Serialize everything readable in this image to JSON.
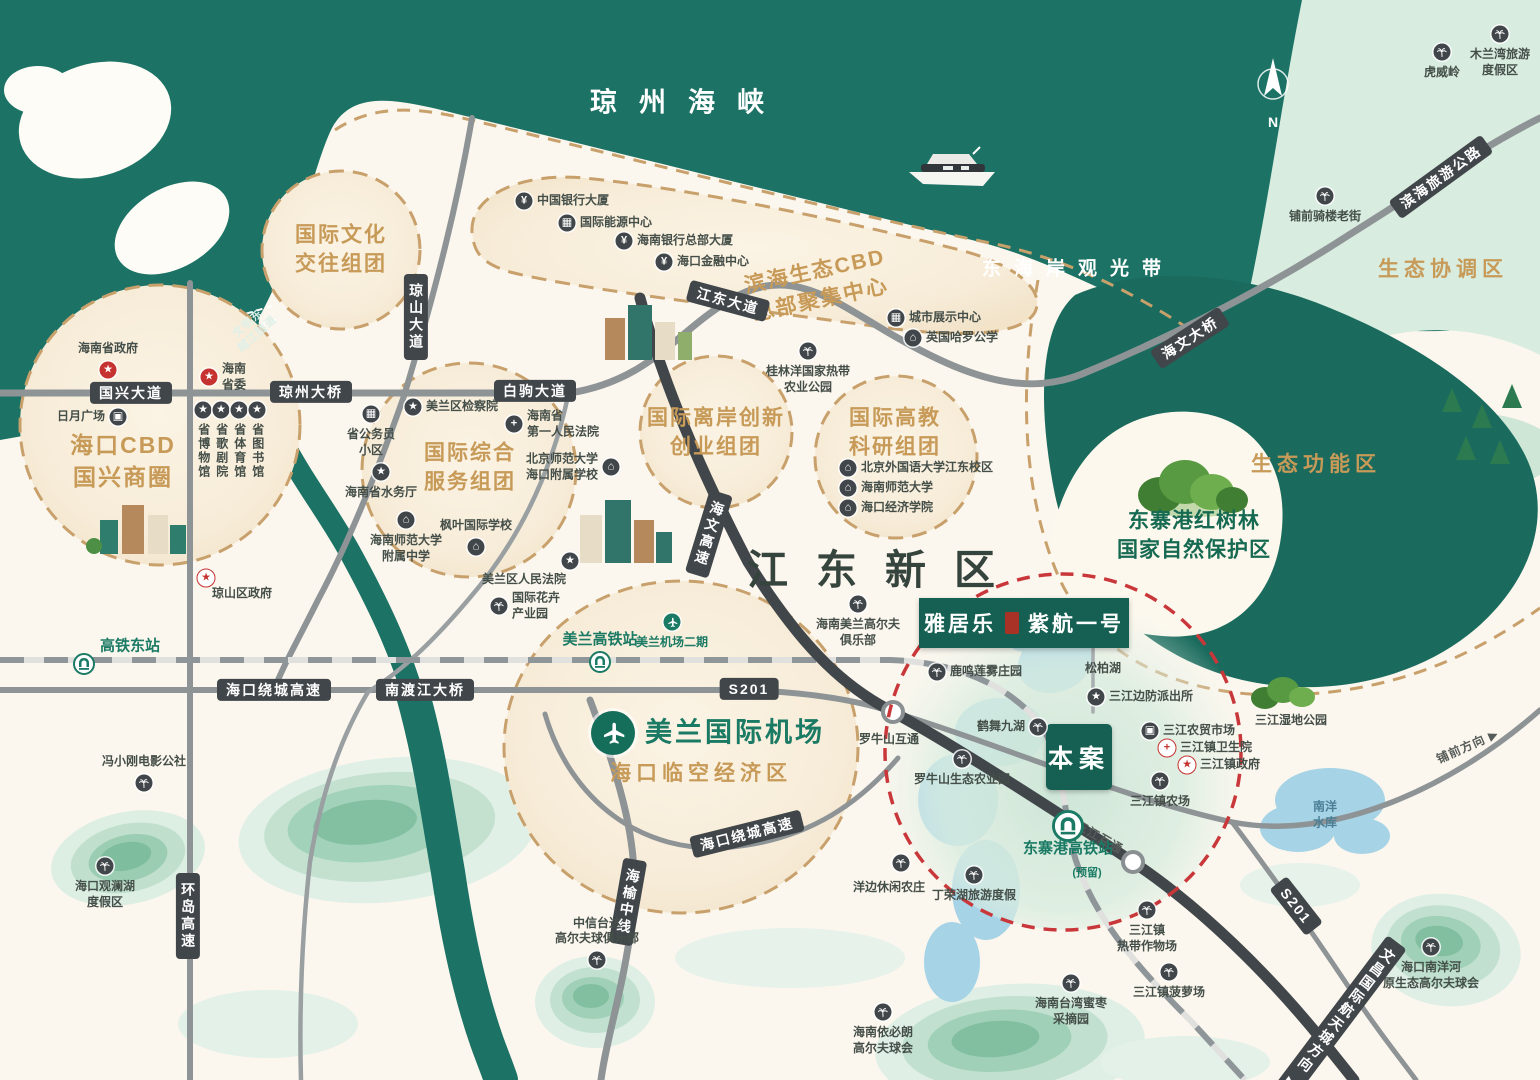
{
  "meta": {
    "compass": "N"
  },
  "banner": {
    "brand": "雅居乐",
    "project": "紫航一号"
  },
  "site_marker": "本案",
  "colors": {
    "sea": "#1b7265",
    "gold": "#c79a58",
    "green": "#1a7a64",
    "red_dash": "#c9373a",
    "road_dark": "#41464a",
    "tan_dash": "#c8a06b"
  },
  "area_labels": [
    {
      "text": "琼州海峡",
      "x": 688,
      "y": 100,
      "cls": "al-sea"
    },
    {
      "text": "东海岸观光带",
      "x": 1078,
      "y": 267,
      "cls": "al-coast"
    },
    {
      "text": "江东新区",
      "x": 885,
      "y": 566,
      "cls": "al-district"
    },
    {
      "text": "滨海生态CBD\n总部聚集中心",
      "x": 818,
      "y": 286,
      "cls": "al-gold-md",
      "rot": -12
    },
    {
      "text": "国际文化\n交往组团",
      "x": 341,
      "y": 250,
      "cls": "al-gold-md"
    },
    {
      "text": "国际综合\n服务组团",
      "x": 470,
      "y": 468,
      "cls": "al-gold-md"
    },
    {
      "text": "国际离岸创新\n创业组团",
      "x": 716,
      "y": 433,
      "cls": "al-gold-md"
    },
    {
      "text": "国际高教\n科研组团",
      "x": 895,
      "y": 433,
      "cls": "al-gold-md"
    },
    {
      "text": "海口CBD\n国兴商圈",
      "x": 123,
      "y": 461,
      "cls": "al-gold-lg"
    },
    {
      "text": "海口临空经济区",
      "x": 701,
      "y": 772,
      "cls": "al-gold-md2"
    },
    {
      "text": "生态协调区",
      "x": 1443,
      "y": 268,
      "cls": "al-gold-md2"
    },
    {
      "text": "生态功能区",
      "x": 1316,
      "y": 463,
      "cls": "al-gold-md2"
    },
    {
      "text": "东寨港红树林\n国家自然保护区",
      "x": 1194,
      "y": 536,
      "cls": "al-green-dk"
    },
    {
      "text": "文明东\n越江隧道",
      "x": 253,
      "y": 329,
      "cls": "al-tunnel",
      "rot": -42
    },
    {
      "text": "(预留)",
      "x": 1087,
      "y": 872,
      "cls": "al-green-sm"
    }
  ],
  "road_labels": [
    {
      "text": "国兴大道",
      "x": 131,
      "y": 393
    },
    {
      "text": "琼州大桥",
      "x": 311,
      "y": 392
    },
    {
      "text": "白驹大道",
      "x": 535,
      "y": 391
    },
    {
      "text": "江东大道",
      "x": 728,
      "y": 301,
      "rot": 15
    },
    {
      "text": "海文大桥",
      "x": 1190,
      "y": 338,
      "rot": -33
    },
    {
      "text": "滨海旅游公路",
      "x": 1441,
      "y": 177,
      "rot": -36
    },
    {
      "text": "琼山大道",
      "x": 416,
      "y": 317,
      "vertical": true
    },
    {
      "text": "海文高速",
      "x": 709,
      "y": 534,
      "vertical": true,
      "rot": 17
    },
    {
      "text": "海口绕城高速",
      "x": 274,
      "y": 690
    },
    {
      "text": "南渡江大桥",
      "x": 425,
      "y": 690
    },
    {
      "text": "S201",
      "x": 749,
      "y": 689
    },
    {
      "text": "海口绕城高速",
      "x": 747,
      "y": 834,
      "rot": -14
    },
    {
      "text": "海榆中线",
      "x": 628,
      "y": 902,
      "vertical": true,
      "rot": 10
    },
    {
      "text": "环岛高速",
      "x": 188,
      "y": 916,
      "vertical": true
    },
    {
      "text": "S201",
      "x": 1296,
      "y": 906,
      "rot": 52
    },
    {
      "text": "文昌国际航天城方向 ▶",
      "x": 1338,
      "y": 1021,
      "vertical": true,
      "rot": 37
    },
    {
      "text": "三江互通",
      "x": 1099,
      "y": 838,
      "rot": 30,
      "plain": true
    },
    {
      "text": "铺前方向 ▶",
      "x": 1468,
      "y": 747,
      "rot": -24,
      "plain": true
    }
  ],
  "pois": [
    {
      "t": "redgov",
      "label": "海南省政府",
      "x": 108,
      "y": 370,
      "side": "above"
    },
    {
      "t": "redgov",
      "label": "海南\n省委",
      "x": 209,
      "y": 377,
      "side": "right"
    },
    {
      "t": "market",
      "label": "日月广场",
      "x": 118,
      "y": 417,
      "side": "left"
    },
    {
      "t": "star",
      "label": "省博物馆",
      "x": 203,
      "y": 410,
      "side": "below",
      "vert": true
    },
    {
      "t": "star",
      "label": "省歌剧院",
      "x": 221,
      "y": 410,
      "side": "below",
      "vert": true
    },
    {
      "t": "star",
      "label": "省体育馆",
      "x": 239,
      "y": 410,
      "side": "below",
      "vert": true
    },
    {
      "t": "star",
      "label": "省图书馆",
      "x": 257,
      "y": 410,
      "side": "below",
      "vert": true
    },
    {
      "t": "redstar",
      "label": "琼山区政府",
      "x": 206,
      "y": 578,
      "lx": 242,
      "ly": 594
    },
    {
      "t": "bank",
      "label": "中国银行大厦",
      "x": 524,
      "y": 201
    },
    {
      "t": "building",
      "label": "国际能源中心",
      "x": 567,
      "y": 223
    },
    {
      "t": "bank",
      "label": "海南银行总部大厦",
      "x": 624,
      "y": 241
    },
    {
      "t": "bank",
      "label": "海口金融中心",
      "x": 664,
      "y": 262
    },
    {
      "t": "building",
      "label": "城市展示中心",
      "x": 896,
      "y": 318
    },
    {
      "t": "school",
      "label": "英国哈罗公学",
      "x": 913,
      "y": 338
    },
    {
      "t": "palm",
      "label": "桂林洋国家热带\n农业公园",
      "x": 808,
      "y": 351,
      "side": "below"
    },
    {
      "t": "building",
      "label": "省公务员\n小区",
      "x": 371,
      "y": 414,
      "side": "below"
    },
    {
      "t": "star",
      "label": "美兰区检察院",
      "x": 413,
      "y": 407
    },
    {
      "t": "cross",
      "label": "海南省\n第一人民法院",
      "x": 514,
      "y": 424
    },
    {
      "t": "star",
      "label": "海南省水务厅",
      "x": 381,
      "y": 472,
      "side": "below"
    },
    {
      "t": "school",
      "label": "海南师范大学\n附属中学",
      "x": 406,
      "y": 520,
      "side": "below"
    },
    {
      "t": "school",
      "label": "枫叶国际学校",
      "x": 476,
      "y": 547,
      "side": "above"
    },
    {
      "t": "school",
      "label": "北京师范大学\n海口附属学校",
      "x": 611,
      "y": 467,
      "side": "left"
    },
    {
      "t": "star",
      "label": "美兰区人民法院",
      "x": 570,
      "y": 561,
      "lx": 524,
      "ly": 580
    },
    {
      "t": "palm",
      "label": "国际花卉\n产业园",
      "x": 499,
      "y": 606
    },
    {
      "t": "school",
      "label": "北京外国语大学江东校区",
      "x": 848,
      "y": 468
    },
    {
      "t": "school",
      "label": "海南师范大学",
      "x": 848,
      "y": 488
    },
    {
      "t": "school",
      "label": "海口经济学院",
      "x": 848,
      "y": 508
    },
    {
      "t": "palm",
      "label": "海南美兰高尔夫\n俱乐部",
      "x": 858,
      "y": 604,
      "side": "below"
    },
    {
      "t": "palm",
      "label": "鹿鸣莲雾庄园",
      "x": 937,
      "y": 672
    },
    {
      "label": "松柏湖",
      "x": 1103,
      "y": 669
    },
    {
      "t": "star",
      "label": "三江边防派出所",
      "x": 1096,
      "y": 697
    },
    {
      "t": "palm",
      "label": "鹤舞九湖",
      "x": 1038,
      "y": 727,
      "side": "left"
    },
    {
      "t": "palm",
      "label": "罗牛山生态农业园",
      "x": 962,
      "y": 759,
      "side": "below"
    },
    {
      "label": "罗牛山互通",
      "x": 889,
      "y": 740
    },
    {
      "t": "market",
      "label": "三江农贸市场",
      "x": 1150,
      "y": 731
    },
    {
      "t": "crossred",
      "label": "三江镇卫生院",
      "x": 1167,
      "y": 748
    },
    {
      "t": "redstar",
      "label": "三江镇政府",
      "x": 1187,
      "y": 765
    },
    {
      "t": "palm",
      "label": "三江镇农场",
      "x": 1160,
      "y": 781,
      "side": "below"
    },
    {
      "t": "railbig",
      "label": "东寨港高铁站",
      "x": 1068,
      "y": 826,
      "side": "below",
      "cls": "green"
    },
    {
      "t": "palm",
      "label": "丁荣湖旅游度假",
      "x": 974,
      "y": 875,
      "side": "below"
    },
    {
      "t": "palm",
      "label": "洋边休闲农庄",
      "x": 901,
      "y": 863,
      "lx": 889,
      "ly": 888
    },
    {
      "t": "palm",
      "label": "三江镇\n热带作物场",
      "x": 1147,
      "y": 910,
      "side": "below"
    },
    {
      "t": "palm",
      "label": "三江镇菠萝场",
      "x": 1169,
      "y": 972,
      "side": "below"
    },
    {
      "t": "palm",
      "label": "海南台湾蜜枣\n采摘园",
      "x": 1071,
      "y": 983,
      "side": "below"
    },
    {
      "t": "palm",
      "label": "海南依必朗\n高尔夫球会",
      "x": 883,
      "y": 1012,
      "side": "below"
    },
    {
      "t": "palm",
      "label": "中信台达\n高尔夫球俱乐部",
      "x": 597,
      "y": 960,
      "side": "above"
    },
    {
      "t": "palm",
      "label": "冯小刚电影公社",
      "x": 144,
      "y": 783,
      "side": "above"
    },
    {
      "t": "palm",
      "label": "海口观澜湖\n度假区",
      "x": 105,
      "y": 866,
      "side": "below"
    },
    {
      "t": "rail",
      "label": "高铁东站",
      "x": 84,
      "y": 664,
      "cls": "green",
      "lx": 130,
      "ly": 646
    },
    {
      "t": "rail",
      "label": "美兰高铁站",
      "x": 600,
      "y": 662,
      "side": "above",
      "cls": "green"
    },
    {
      "t": "plane",
      "label": "美兰机场二期",
      "x": 672,
      "y": 622,
      "side": "below",
      "cls": "green-sm"
    },
    {
      "t": "planebig",
      "label": "美兰国际机场",
      "x": 613,
      "y": 733,
      "cls": "airport"
    },
    {
      "t": "palm",
      "label": "铺前骑楼老街",
      "x": 1325,
      "y": 196,
      "side": "below"
    },
    {
      "t": "palm",
      "label": "虎威岭",
      "x": 1442,
      "y": 52,
      "side": "below"
    },
    {
      "t": "palm",
      "label": "木兰湾旅游\n度假区",
      "x": 1500,
      "y": 34,
      "side": "below"
    },
    {
      "label": "南洋\n水库",
      "x": 1325,
      "y": 815,
      "cls": "water"
    },
    {
      "t": "palm",
      "label": "海口南洋河\n原生态高尔夫球会",
      "x": 1431,
      "y": 947,
      "side": "below"
    },
    {
      "label": "三江湿地公园",
      "x": 1291,
      "y": 721
    }
  ]
}
